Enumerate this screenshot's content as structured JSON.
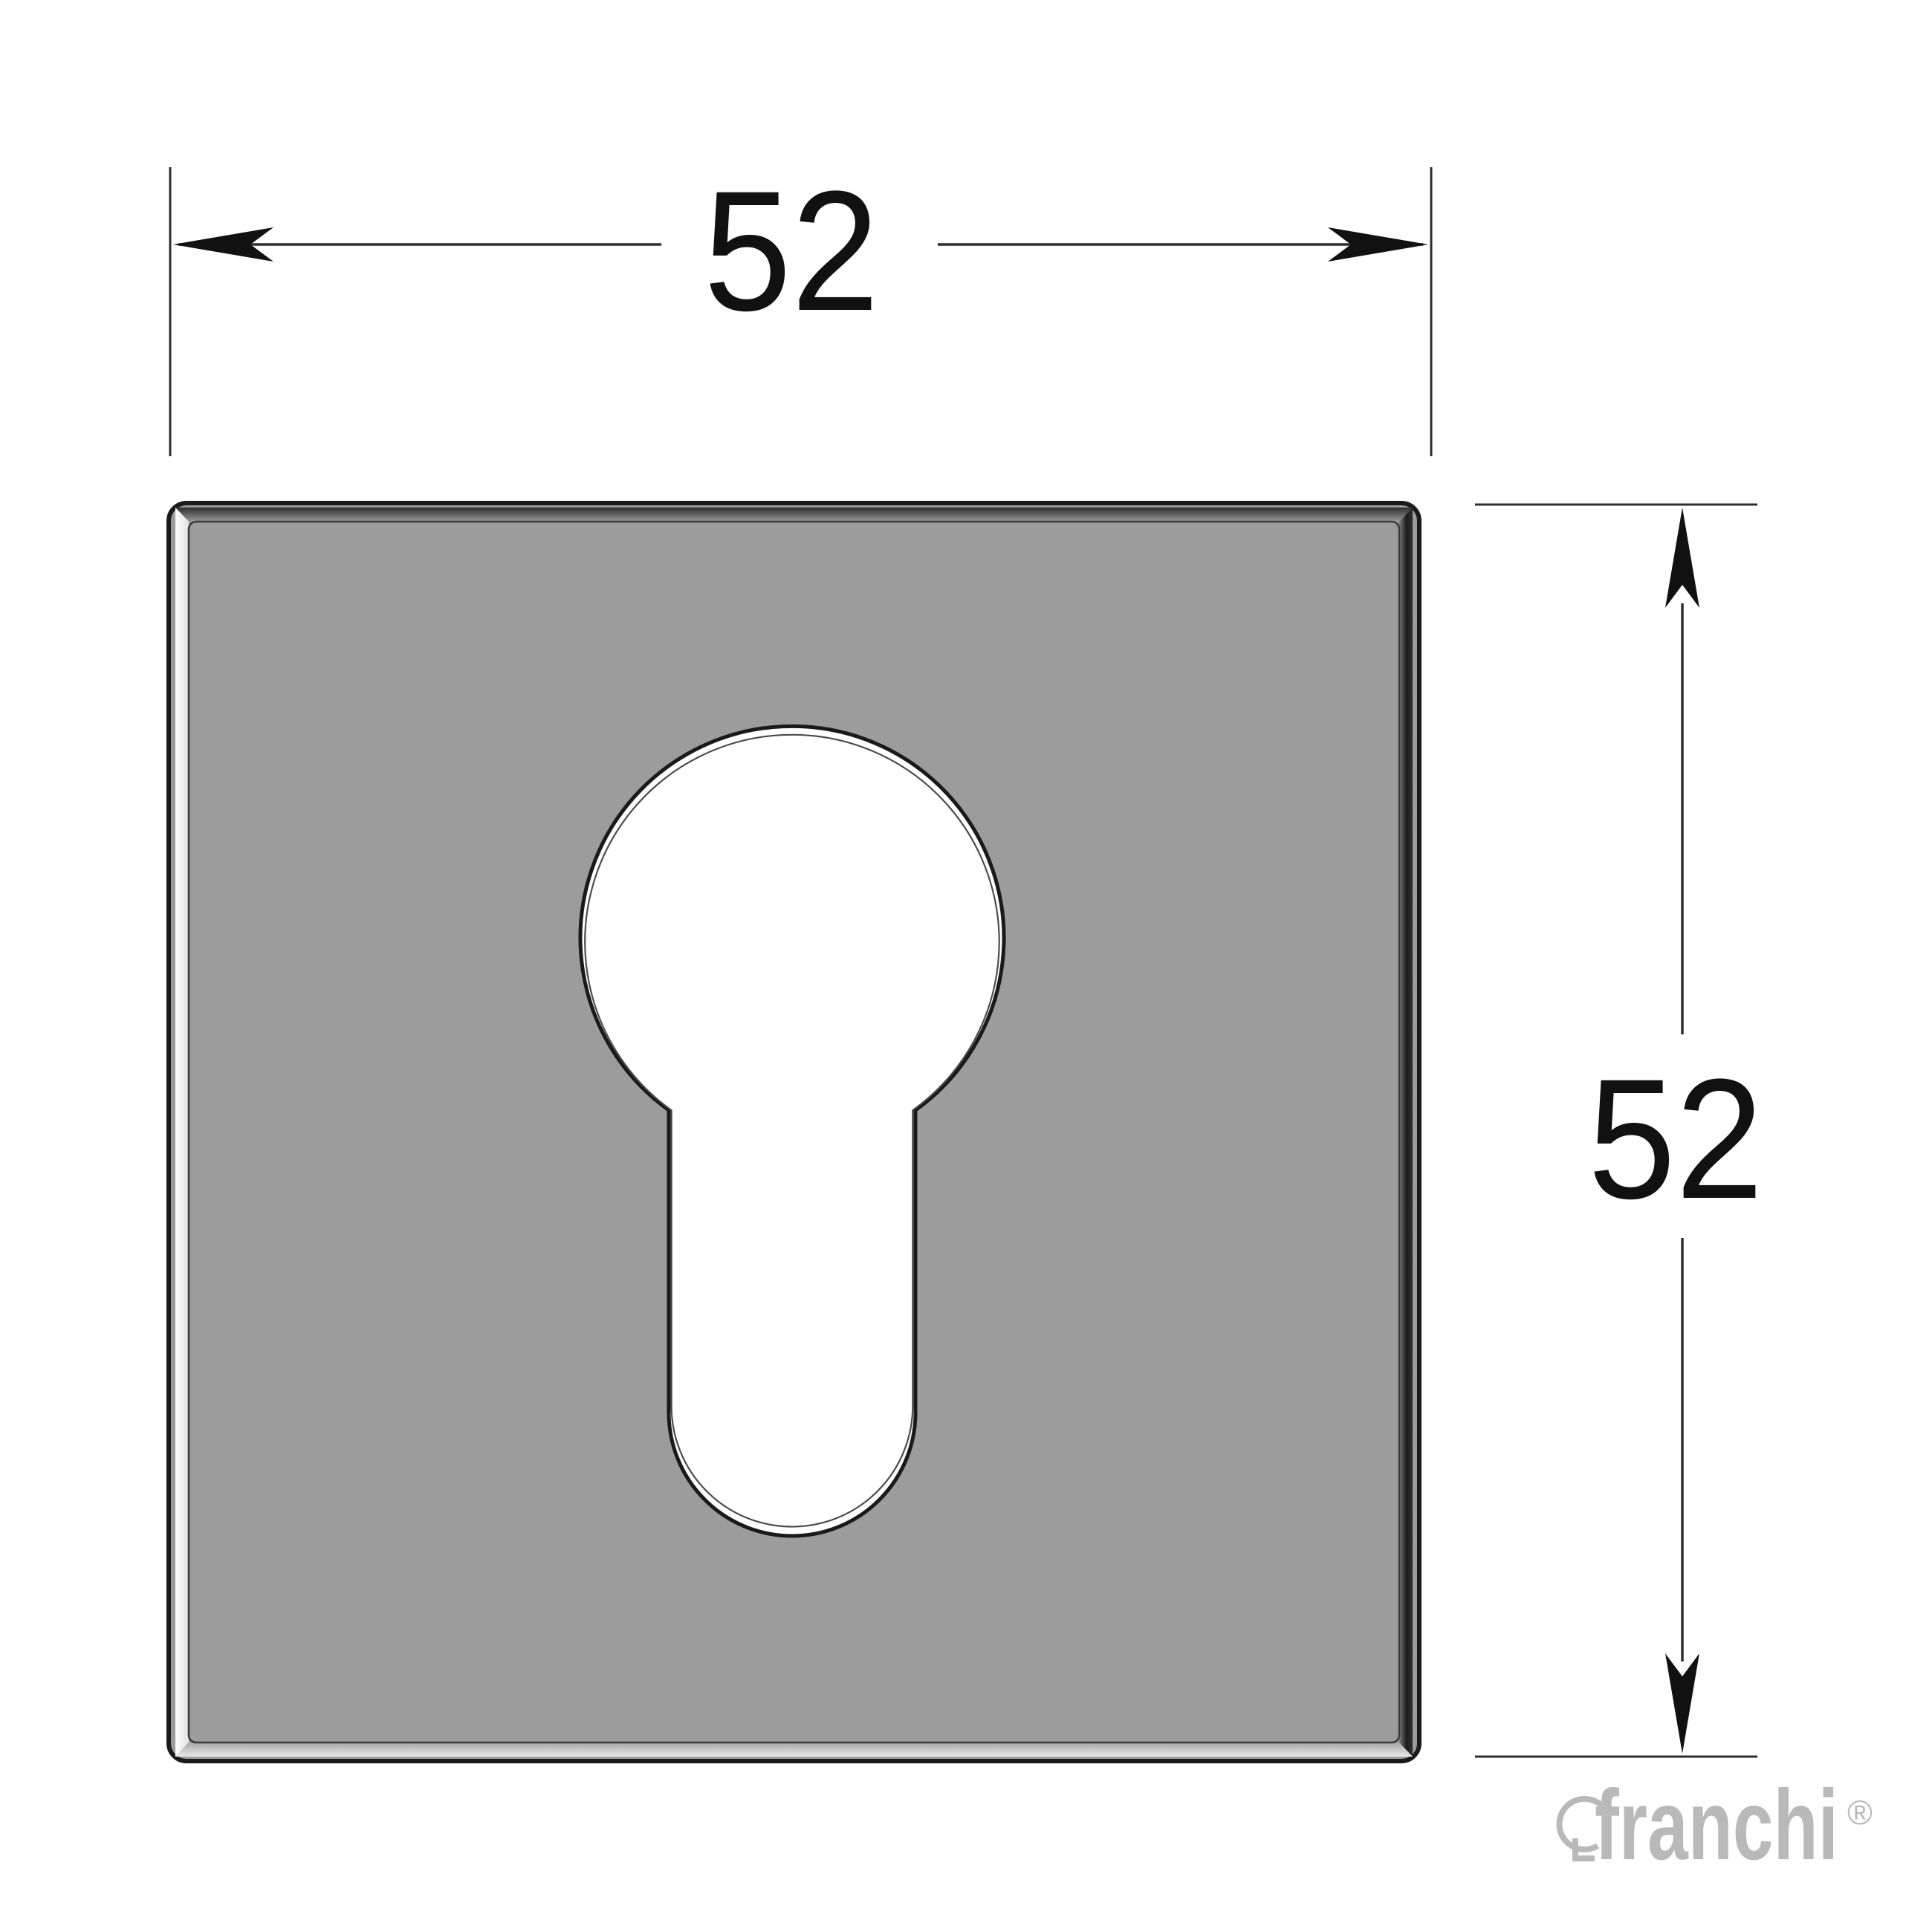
{
  "drawing": {
    "width_label": "52",
    "height_label": "52"
  },
  "brand": {
    "name": "franchi",
    "registered_mark": "®"
  },
  "colors": {
    "background": "#ffffff",
    "plate_face": "#9c9c9c",
    "plate_outline": "#1a1a1a",
    "plate_bevel_left": "#f6f6f6",
    "plate_bevel_top_dark": "#303030",
    "plate_bevel_right_dark": "#141414",
    "plate_bevel_bottom_light": "#e9e9e9",
    "keyhole_fill": "#ffffff",
    "dimension_lines": "#2e2e2e",
    "dimension_text": "#111111",
    "logo_gray": "#b9b9b9"
  },
  "icons": {
    "cutout": "keyhole-icon",
    "brand_mark": "keyhole-outline-icon"
  }
}
